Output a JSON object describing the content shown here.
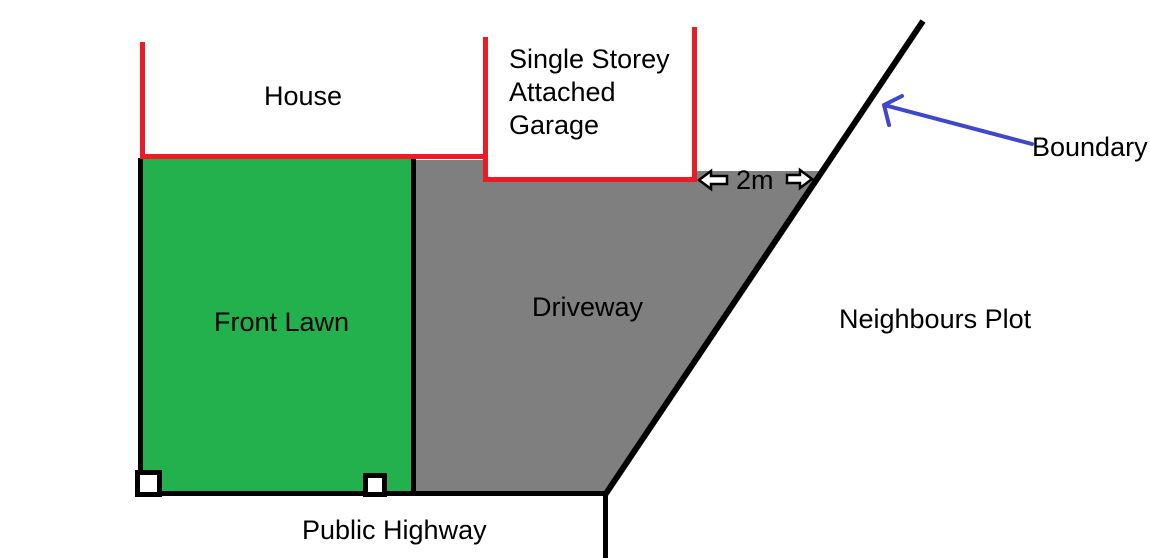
{
  "diagram": {
    "type": "property-plot-plan-sketch",
    "labels": {
      "house": "House",
      "garage_line1": "Single Storey",
      "garage_line2": "Attached",
      "garage_line3": "Garage",
      "front_lawn": "Front Lawn",
      "driveway": "Driveway",
      "neighbours_plot": "Neighbours Plot",
      "boundary": "Boundary",
      "distance": "2m",
      "public_highway": "Public Highway"
    },
    "colors": {
      "lawn_green": "#22B14C",
      "driveway_gray": "#7F7F7F",
      "building_red": "#ED1C24",
      "line_black": "#000000",
      "arrow_blue": "#3F48CC",
      "marker_white": "#FFFFFF",
      "background": "#FFFFFF"
    }
  }
}
